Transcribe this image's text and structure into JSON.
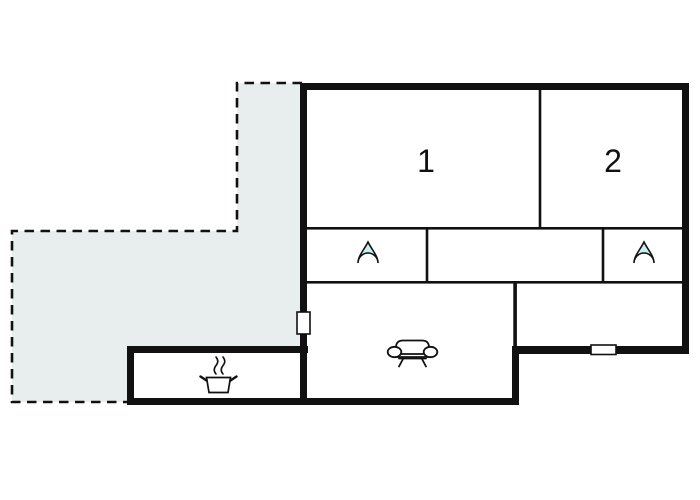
{
  "diagram": {
    "type": "floor-plan",
    "background": "#ffffff"
  },
  "colors": {
    "wall": "#111111",
    "terrace_fill": "#e8eeed",
    "terrace_border": "#111111",
    "door_fill": "#ffffff",
    "water_drop_fill": "#c9eff2",
    "icon_stroke": "#111111",
    "icon_fill": "#ffffff",
    "label": "#111111"
  },
  "rooms": {
    "room1": {
      "label": "1"
    },
    "room2": {
      "label": "2"
    }
  },
  "icons": [
    {
      "name": "water-drop-icon",
      "location": "bathroom-left"
    },
    {
      "name": "water-drop-icon",
      "location": "bathroom-right"
    },
    {
      "name": "sofa-icon",
      "location": "living-room"
    },
    {
      "name": "stove-pot-icon",
      "location": "kitchen"
    },
    {
      "name": "door-marker",
      "location": "left-wall"
    },
    {
      "name": "door-marker",
      "location": "bottom-right-wall"
    }
  ]
}
